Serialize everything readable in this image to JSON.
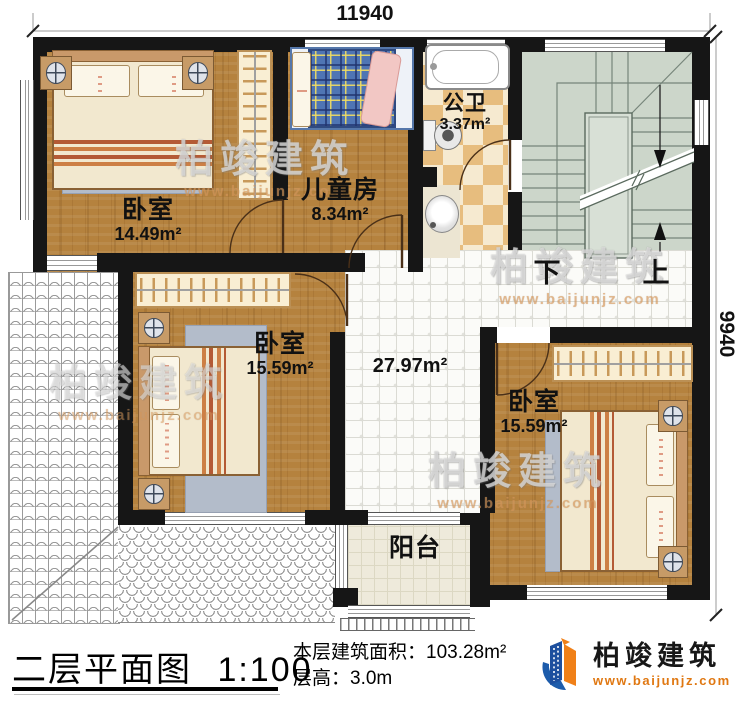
{
  "dimensions": {
    "top": "11940",
    "right": "9940"
  },
  "rooms": {
    "bedroom1": {
      "name": "卧室",
      "area": "14.49m²"
    },
    "kids": {
      "name": "儿童房",
      "area": "8.34m²"
    },
    "bath": {
      "name": "公卫",
      "area": "3.37m²"
    },
    "bedroom2": {
      "name": "卧室",
      "area": "15.59m²"
    },
    "bedroom3": {
      "name": "卧室",
      "area": "15.59m²"
    },
    "hall": {
      "area": "27.97m²"
    },
    "balcony": {
      "name": "阳台"
    }
  },
  "stairs": {
    "down": "下",
    "up": "上"
  },
  "title_block": {
    "plan_name": "二层平面图",
    "scale": "1:100",
    "area_label": "本层建筑面积：",
    "area_value": "103.28m²",
    "height_label": "层高：",
    "height_value": "3.0m"
  },
  "logo": {
    "name": "柏竣建筑",
    "url": "www.baijunjz.com"
  },
  "watermark": {
    "text": "柏竣建筑",
    "url": "www.baijunjz.com"
  },
  "colors": {
    "wall": "#161616",
    "wood": "#b5823e",
    "stairs": "#ccd6ca",
    "checker_tan": "#e7bd7e",
    "logo_blue": "#1d4f9e",
    "logo_orange": "#f08018",
    "url_orange": "#e07812",
    "kids_bed_blue": "#4f75b4"
  }
}
